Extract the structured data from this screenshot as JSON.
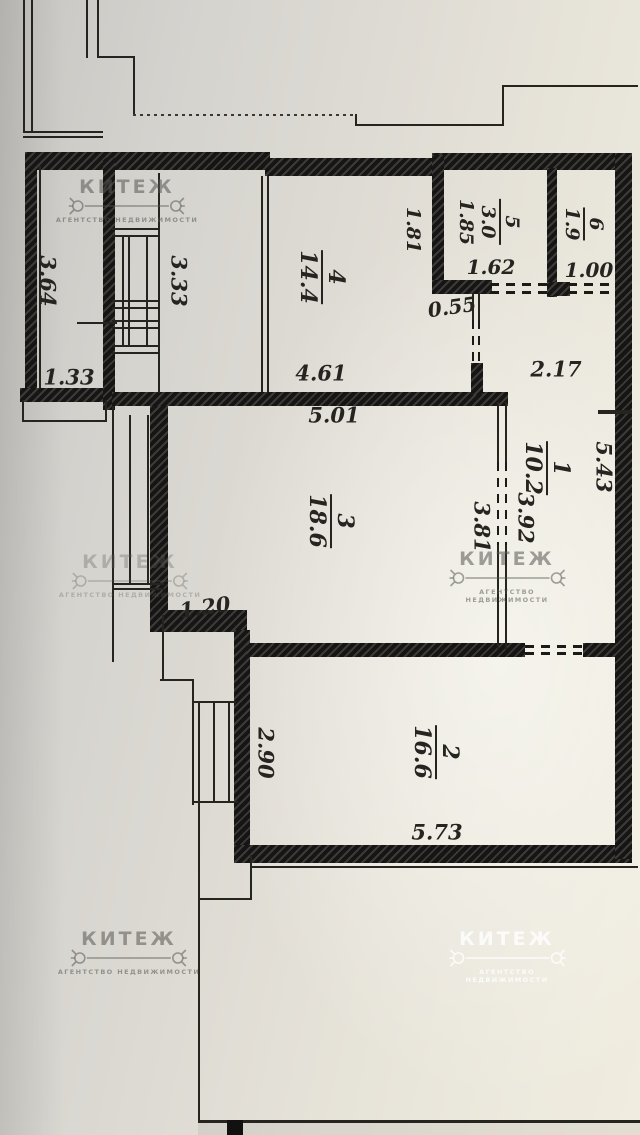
{
  "watermark": {
    "name": "КИТЕЖ",
    "subtitle": "агентство недвижимости"
  },
  "rooms": {
    "r1": {
      "number": "1",
      "area": "10.2"
    },
    "r2": {
      "number": "2",
      "area": "16.6"
    },
    "r3": {
      "number": "3",
      "area": "18.6"
    },
    "r4": {
      "number": "4",
      "area": "14.4"
    },
    "r5": {
      "number": "5",
      "area": "3.0",
      "extra": "1.85"
    },
    "r6": {
      "number": "6",
      "area": "1.9"
    }
  },
  "dims": {
    "v364": "3.64",
    "v333": "3.33",
    "v133": "1.33",
    "v181": "1.81",
    "v162": "1.62",
    "v100": "1.00",
    "v055": "0.55",
    "v217": "2.17",
    "v461": "4.61",
    "v501": "5.01",
    "v543": "5.43",
    "v392": "3.92",
    "v381": "3.81",
    "v120": "1.20",
    "v290": "2.90",
    "v573": "5.73"
  }
}
